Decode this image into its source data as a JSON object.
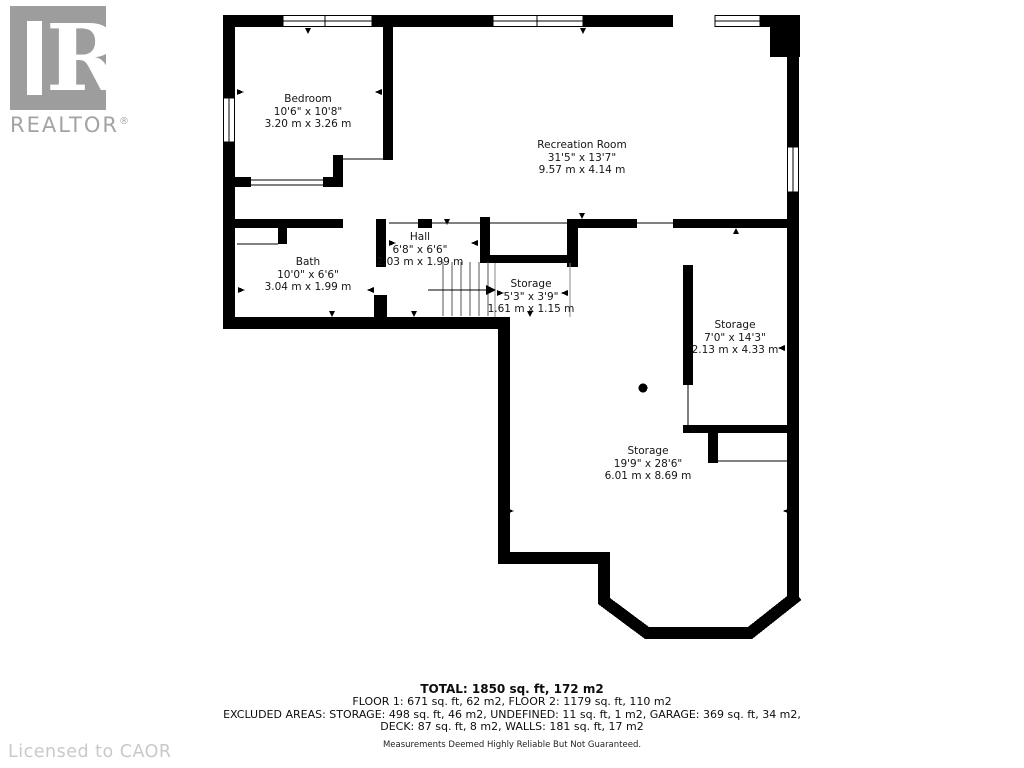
{
  "branding": {
    "logo_letter": "R",
    "logo_label": "REALTOR",
    "logo_reg": "®",
    "license": "Licensed to CAOR"
  },
  "rooms": [
    {
      "name": "Bedroom",
      "imperial": "10'6\" x 10'8\"",
      "metric": "3.20 m x 3.26 m"
    },
    {
      "name": "Recreation Room",
      "imperial": "31'5\" x 13'7\"",
      "metric": "9.57 m x 4.14 m"
    },
    {
      "name": "Hall",
      "imperial": "6'8\" x 6'6\"",
      "metric": "2.03 m x 1.99 m"
    },
    {
      "name": "Bath",
      "imperial": "10'0\" x 6'6\"",
      "metric": "3.04 m x 1.99 m"
    },
    {
      "name": "Storage",
      "imperial": "5'3\" x 3'9\"",
      "metric": "1.61 m x 1.15 m"
    },
    {
      "name": "Storage",
      "imperial": "7'0\" x 14'3\"",
      "metric": "2.13 m x 4.33 m"
    },
    {
      "name": "Storage",
      "imperial": "19'9\" x 28'6\"",
      "metric": "6.01 m x 8.69 m"
    }
  ],
  "summary": {
    "total": "TOTAL: 1850 sq. ft, 172 m2",
    "floors": "FLOOR 1: 671 sq. ft, 62 m2, FLOOR 2: 1179 sq. ft, 110 m2",
    "excluded_1": "EXCLUDED AREAS: STORAGE: 498 sq. ft, 46 m2, UNDEFINED: 11 sq. ft, 1 m2, GARAGE: 369 sq. ft, 34 m2,",
    "excluded_2": "DECK: 87 sq. ft, 8 m2, WALLS: 181 sq. ft, 17 m2",
    "disclaimer": "Measurements Deemed Highly Reliable But Not Guaranteed."
  },
  "colors": {
    "wall": "#000000",
    "logo_gray": "#9d9d9d",
    "license_gray": "#c9c9c9"
  }
}
